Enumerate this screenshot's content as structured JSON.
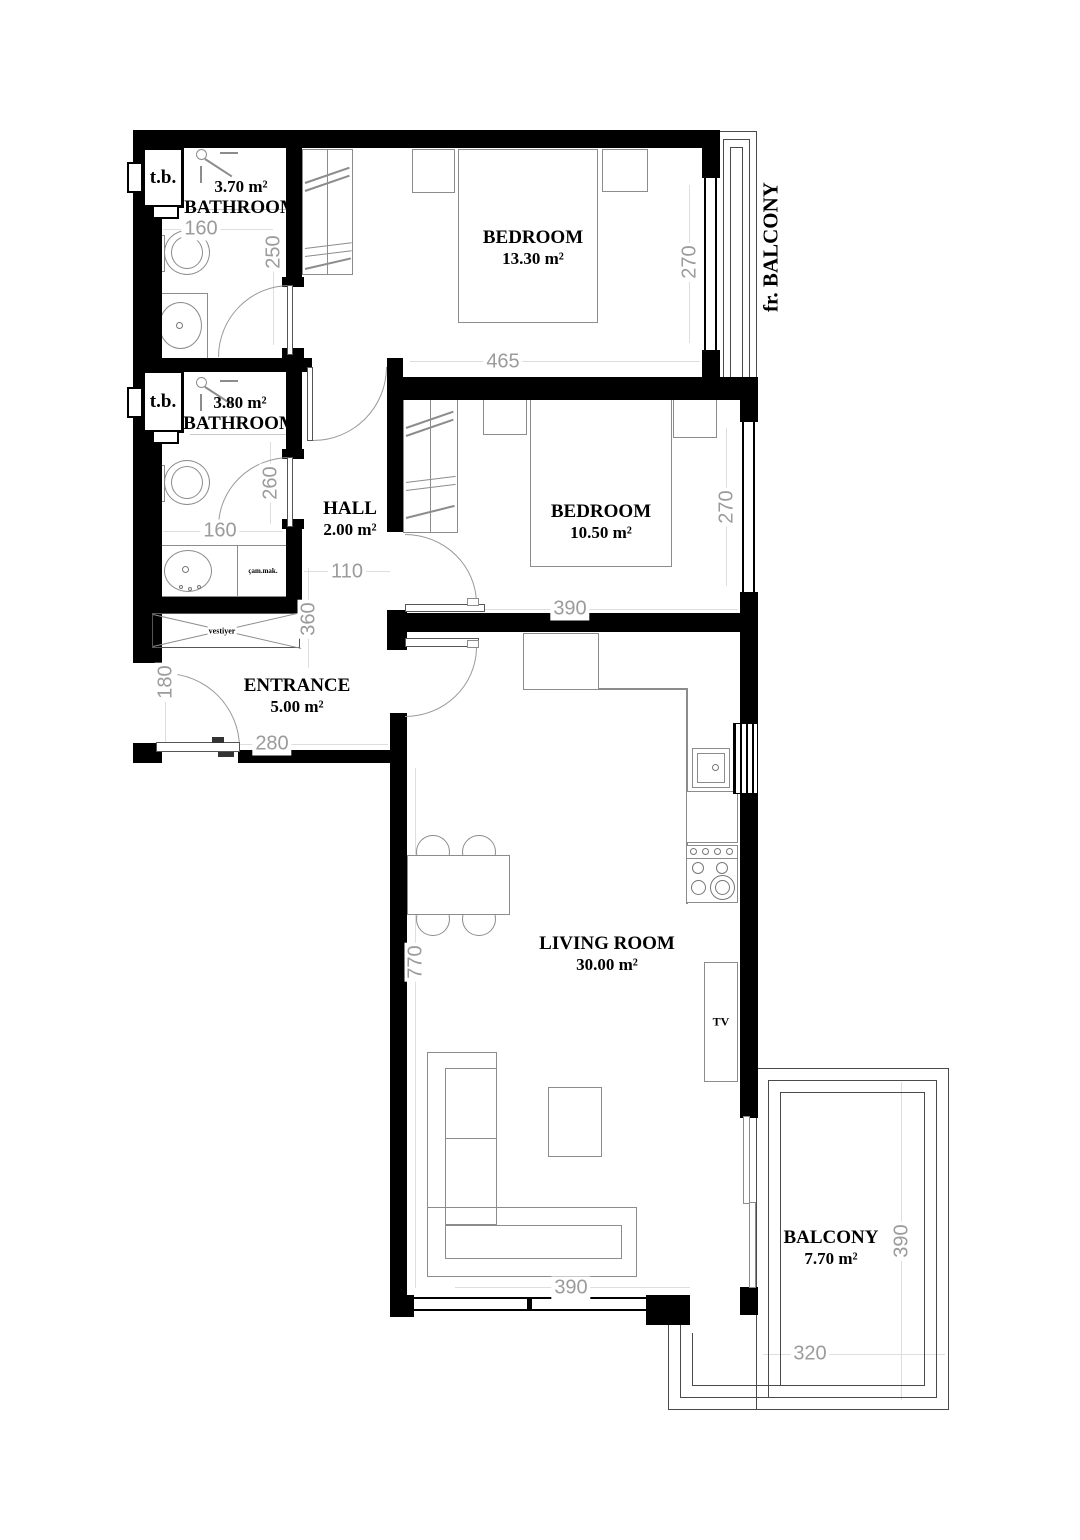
{
  "rooms": {
    "bathroom1": {
      "area": "3.70 m²",
      "name": "BATHROOM"
    },
    "bedroom1": {
      "name": "BEDROOM",
      "area": "13.30 m²"
    },
    "bathroom2": {
      "area": "3.80 m²",
      "name": "BATHROOM"
    },
    "hall": {
      "name": "HALL",
      "area": "2.00 m²"
    },
    "bedroom2": {
      "name": "BEDROOM",
      "area": "10.50 m²"
    },
    "entrance": {
      "name": "ENTRANCE",
      "area": "5.00 m²"
    },
    "living_room": {
      "name": "LIVING ROOM",
      "area": "30.00 m²"
    },
    "balcony": {
      "name": "BALCONY",
      "area": "7.70 m²"
    },
    "french_balcony": {
      "name": "fr. BALCONY"
    }
  },
  "fixtures": {
    "tb": "t.b.",
    "vestiyer": "vestiyer",
    "washing_machine": "çam.mak.",
    "fridge": "BUZDOLABI",
    "dishwasher": "BUL.MAK.",
    "tv": "TV"
  },
  "dims": {
    "bath1_w": "160",
    "bath1_d": "250",
    "bath2_d": "260",
    "bath2_w": "160",
    "bed1_w": "465",
    "bed1_d": "270",
    "bed2_w": "390",
    "bed2_d": "270",
    "hall_w": "110",
    "hall_d": "360",
    "ent_d": "180",
    "ent_w": "280",
    "lr_d": "770",
    "lr_w": "390",
    "bal_d": "390",
    "bal_w": "320"
  },
  "colors": {
    "wall": "#000000",
    "dimension_text": "#9b9b9b",
    "furniture_line": "#8c8c8c"
  }
}
